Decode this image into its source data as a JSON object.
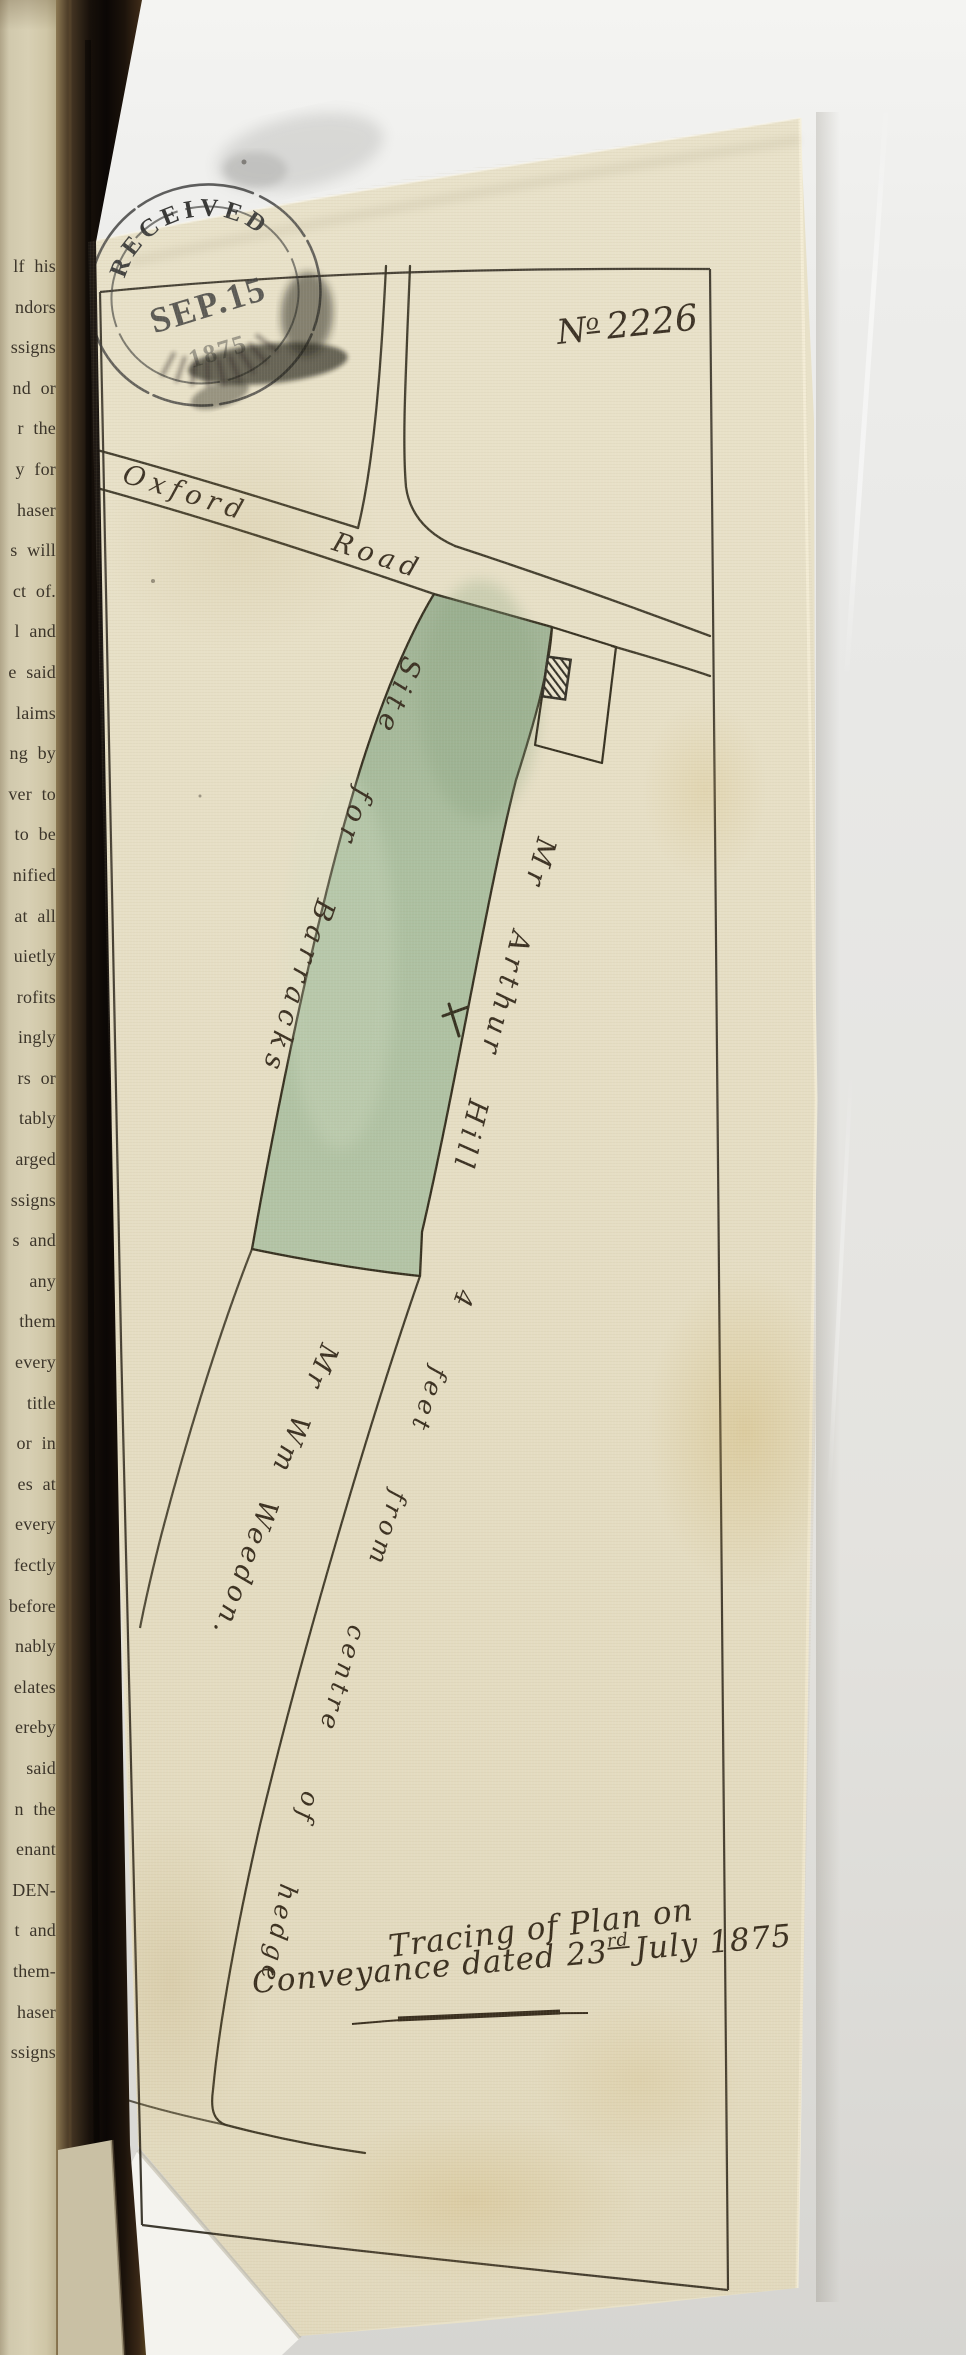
{
  "plan": {
    "number_prefix": "N",
    "number_sup": "o",
    "number_value": "2226",
    "road_label_1": "Oxford",
    "road_label_2": "Road",
    "parcel_label": "Site for Barracks",
    "east_owner_label": "Mr Arthur Hill",
    "boundary_note": "4 feet from centre of hedge",
    "south_owner_label": "Mr Wm Weedon.",
    "caption_line1": "Tracing of Plan on",
    "caption_line2_a": "Conveyance dated 23",
    "caption_line2_sup": "rd",
    "caption_line2_b": "July 1875",
    "pencil_note": "×3"
  },
  "stamp": {
    "top": "RECEIVED",
    "middle": "SEP.15",
    "year": "1875"
  },
  "book_page": {
    "fragments": [
      "lf his",
      "ndors",
      "ssigns",
      "nd or",
      "r the",
      "y for",
      "haser",
      "s will",
      "ct of.",
      "l and",
      "e said",
      "laims",
      "ng by",
      "ver to",
      "to be",
      "nified",
      "at all",
      "uietly",
      "rofits",
      "ingly",
      "rs or",
      "tably",
      "arged",
      "ssigns",
      "s and",
      "any",
      "them",
      "every",
      "title",
      "or in",
      "es at",
      "every",
      "fectly",
      "before",
      "nably",
      "elates",
      "ereby",
      "said",
      "n the",
      "enant",
      "DEN-",
      "t and",
      "them-",
      "haser",
      "ssigns"
    ]
  },
  "colors": {
    "parcel_green": "#a9bfa2",
    "paper": "#e8e1c8",
    "ink": "#2d2819"
  }
}
